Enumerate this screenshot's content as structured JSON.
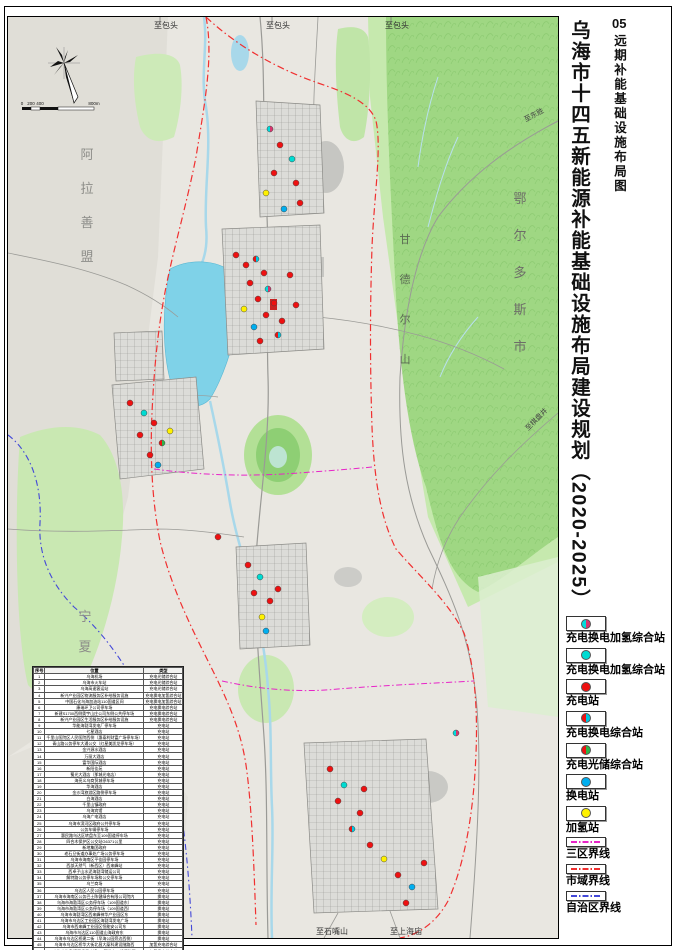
{
  "page": {
    "sheet_number": "05",
    "sheet_title": "远期补能基础设施布局图",
    "main_title": "乌海市十四五新能源补能基础设施布局建设规划（2020-2025）"
  },
  "legend": {
    "items": [
      {
        "label": "充电换电加氢综合站",
        "symbol": "point",
        "colors": [
          "#00DCDC",
          "#D8356E"
        ]
      },
      {
        "label": "充电换电加氢综合站",
        "symbol": "point",
        "colors": [
          "#00DCD2"
        ]
      },
      {
        "label": "充电站",
        "symbol": "point",
        "colors": [
          "#EE1111"
        ]
      },
      {
        "label": "充电换电综合站",
        "symbol": "point",
        "colors": [
          "#EE1111",
          "#00C8E0"
        ]
      },
      {
        "label": "充电光储综合站",
        "symbol": "point",
        "colors": [
          "#EE1111",
          "#2EB34A"
        ]
      },
      {
        "label": "换电站",
        "symbol": "point",
        "colors": [
          "#00AEEF"
        ]
      },
      {
        "label": "加氢站",
        "symbol": "point",
        "colors": [
          "#FFF100"
        ]
      },
      {
        "label": "三区界线",
        "symbol": "line",
        "colors": [
          "#E824C8"
        ]
      },
      {
        "label": "市域界线",
        "symbol": "line",
        "colors": [
          "#F03030"
        ]
      },
      {
        "label": "自治区界线",
        "symbol": "line",
        "colors": [
          "#4348D8"
        ]
      }
    ]
  },
  "table": {
    "headers": [
      "序号",
      "位置",
      "类型"
    ],
    "rows": [
      [
        1,
        "乌海机场",
        "充电光储综合站"
      ],
      [
        2,
        "乌海市火车站",
        "充电光储综合站"
      ],
      [
        3,
        "乌海高速客运站",
        "充电光储综合站"
      ],
      [
        4,
        "新兴产业园区物流服务区补给服务设施",
        "充电换电加氢综合站"
      ],
      [
        5,
        "中国石化乌海加油站110国道区间",
        "充电换电加氢综合站"
      ],
      [
        6,
        "康瑞环卫公司停车场",
        "充电换电综合站"
      ],
      [
        7,
        "新建S1700西侧奥宇山庄公司东侧公共停车场",
        "充电换电综合站"
      ],
      [
        8,
        "新兴产业园区生活服务区补给服务设施",
        "充电换电综合站"
      ],
      [
        9,
        "华能海勃湾发电厂停车场",
        "充电站"
      ],
      [
        10,
        "七星酒店",
        "充电站"
      ],
      [
        11,
        "千里山医院区人民医院西侧（惠泰利财富广场停车场）",
        "充电站"
      ],
      [
        12,
        "青山路公务停车大通公交（红星美凯龙停车场）",
        "充电站"
      ],
      [
        13,
        "金兴源水酒店",
        "充电站"
      ],
      [
        14,
        "万丽大酒店",
        "充电站"
      ],
      [
        15,
        "富华国际酒店",
        "充电站"
      ],
      [
        16,
        "新阳佳苑",
        "充电站"
      ],
      [
        17,
        "蜀光大酒店（那城光电店）",
        "充电站"
      ],
      [
        18,
        "海亮义乌商贸城停车场",
        "充电站"
      ],
      [
        19,
        "华海酒店",
        "充电站"
      ],
      [
        20,
        "金沙湾旅游区路侧停车场",
        "充电站"
      ],
      [
        21,
        "白海酒店",
        "充电站"
      ],
      [
        22,
        "千里山镇政府",
        "充电站"
      ],
      [
        23,
        "乌海宾馆",
        "充电站"
      ],
      [
        24,
        "乌海广电酒店",
        "充电站"
      ],
      [
        25,
        "乌海市滨河区政府公共停车场",
        "充电站"
      ],
      [
        26,
        "公务车辆停车场",
        "充电站"
      ],
      [
        27,
        "惠民路乌达区转盘东至109国道停车场",
        "充电站"
      ],
      [
        28,
        "四合木保护区公交站G6371公里",
        "充电站"
      ],
      [
        29,
        "新地集团政府",
        "充电站"
      ],
      [
        30,
        "老石旦街道办事处广场公务停车场",
        "充电站"
      ],
      [
        31,
        "乌海市海南区平佳园停车场",
        "充电站"
      ],
      [
        32,
        "西部天然气（新西区）西来峰站",
        "充电站"
      ],
      [
        33,
        "西卓子山水泥海勃湾储运公司",
        "充电站"
      ],
      [
        34,
        "解特路公务停车场和公交停车场",
        "充电站"
      ],
      [
        35,
        "乌兰商场",
        "充电站"
      ],
      [
        36,
        "乌达区人民公园停车场",
        "充电站"
      ],
      [
        37,
        "乌海市海南区公务巴士陈健绿合有限公司院内",
        "换电站"
      ],
      [
        38,
        "乌海市海勃湾区公务停车场（109国道东）",
        "换电站"
      ],
      [
        39,
        "乌海市海勃湾区公务停车场（109国道西）",
        "换电站"
      ],
      [
        40,
        "乌海市海勃湾区西来峰神华产业园区东",
        "换电站"
      ],
      [
        41,
        "乌海市乌达区工业园区海勃湾发电广场",
        "换电站"
      ],
      [
        42,
        "乌海市西来峰工业园区恒能安公司东",
        "换电站"
      ],
      [
        43,
        "乌海市乌达区110国道山海政府东",
        "换电站"
      ],
      [
        44,
        "乌海市乌达区桥建二街（早海公园旁边西侧）",
        "换电站"
      ],
      [
        45,
        "乌海市乌达区桥华大街北昌大厦科建设隧路西",
        "加氢充电综合站"
      ],
      [
        46,
        "乌海市海勃湾区千里山镇110国道东、低速路西",
        "加氢换电综合站"
      ]
    ]
  },
  "map": {
    "region_labels": [
      {
        "text": "阿拉善盟",
        "x": 79,
        "y": 142,
        "size": 13,
        "color": "#8d8d89",
        "vertical": true,
        "spacing": 34
      },
      {
        "text": "鄂尔多斯市",
        "x": 512,
        "y": 186,
        "size": 13,
        "color": "#6d6d68",
        "vertical": true,
        "spacing": 37
      },
      {
        "text": "宁夏回",
        "x": 77,
        "y": 604,
        "size": 13,
        "color": "#8d8d89",
        "vertical": true,
        "spacing": 30
      },
      {
        "text": "甘德尔山",
        "x": 397,
        "y": 226,
        "size": 11,
        "color": "#5a6a52",
        "vertical": true,
        "spacing": 40
      }
    ],
    "road_labels": [
      {
        "text": "至包头",
        "x": 158,
        "y": 11,
        "size": 8,
        "color": "#333333"
      },
      {
        "text": "至包头",
        "x": 270,
        "y": 11,
        "size": 8,
        "color": "#333333"
      },
      {
        "text": "至包头",
        "x": 389,
        "y": 11,
        "size": 8,
        "color": "#333333"
      },
      {
        "text": "至石嘴山",
        "x": 324,
        "y": 917,
        "size": 8,
        "color": "#333333"
      },
      {
        "text": "至上海庙",
        "x": 398,
        "y": 917,
        "size": 8,
        "color": "#333333"
      },
      {
        "text": "至东胜",
        "x": 527,
        "y": 100,
        "size": 7,
        "color": "#444444",
        "rotate": -28
      },
      {
        "text": "至棋盘井",
        "x": 530,
        "y": 404,
        "size": 7,
        "color": "#444444",
        "rotate": -45
      }
    ],
    "station_colors": {
      "cs": [
        "#EE1111"
      ],
      "bs": [
        "#00AEEF"
      ],
      "hs": [
        "#FFF100"
      ],
      "ccs": [
        "#EE1111",
        "#00C8E0"
      ],
      "cps": [
        "#EE1111",
        "#2EB34A"
      ],
      "chm": [
        "#00DCDC",
        "#D8356E"
      ],
      "chc": [
        "#00DCD2"
      ]
    },
    "stations": [
      {
        "x": 262,
        "y": 112,
        "t": "chm"
      },
      {
        "x": 272,
        "y": 128,
        "t": "cs"
      },
      {
        "x": 284,
        "y": 142,
        "t": "chc"
      },
      {
        "x": 266,
        "y": 156,
        "t": "cs"
      },
      {
        "x": 288,
        "y": 166,
        "t": "cs"
      },
      {
        "x": 258,
        "y": 176,
        "t": "hs"
      },
      {
        "x": 292,
        "y": 186,
        "t": "cs"
      },
      {
        "x": 276,
        "y": 192,
        "t": "bs"
      },
      {
        "x": 228,
        "y": 238,
        "t": "cs"
      },
      {
        "x": 238,
        "y": 248,
        "t": "cs"
      },
      {
        "x": 248,
        "y": 242,
        "t": "ccs"
      },
      {
        "x": 256,
        "y": 256,
        "t": "cs"
      },
      {
        "x": 242,
        "y": 266,
        "t": "cs"
      },
      {
        "x": 260,
        "y": 272,
        "t": "chm"
      },
      {
        "x": 250,
        "y": 282,
        "t": "cs"
      },
      {
        "x": 266,
        "y": 286,
        "t": "cs"
      },
      {
        "x": 236,
        "y": 292,
        "t": "hs"
      },
      {
        "x": 258,
        "y": 298,
        "t": "cs"
      },
      {
        "x": 274,
        "y": 304,
        "t": "cs"
      },
      {
        "x": 246,
        "y": 310,
        "t": "bs"
      },
      {
        "x": 282,
        "y": 258,
        "t": "cs"
      },
      {
        "x": 288,
        "y": 288,
        "t": "cs"
      },
      {
        "x": 252,
        "y": 324,
        "t": "cs"
      },
      {
        "x": 270,
        "y": 318,
        "t": "ccs"
      },
      {
        "x": 122,
        "y": 386,
        "t": "cs"
      },
      {
        "x": 136,
        "y": 396,
        "t": "chc"
      },
      {
        "x": 146,
        "y": 406,
        "t": "cs"
      },
      {
        "x": 132,
        "y": 418,
        "t": "cs"
      },
      {
        "x": 154,
        "y": 426,
        "t": "cps"
      },
      {
        "x": 142,
        "y": 438,
        "t": "cs"
      },
      {
        "x": 162,
        "y": 414,
        "t": "hs"
      },
      {
        "x": 150,
        "y": 448,
        "t": "bs"
      },
      {
        "x": 240,
        "y": 548,
        "t": "cs"
      },
      {
        "x": 252,
        "y": 560,
        "t": "chc"
      },
      {
        "x": 246,
        "y": 576,
        "t": "cs"
      },
      {
        "x": 262,
        "y": 584,
        "t": "cs"
      },
      {
        "x": 254,
        "y": 600,
        "t": "hs"
      },
      {
        "x": 270,
        "y": 572,
        "t": "cs"
      },
      {
        "x": 258,
        "y": 614,
        "t": "bs"
      },
      {
        "x": 322,
        "y": 752,
        "t": "cs"
      },
      {
        "x": 336,
        "y": 768,
        "t": "chc"
      },
      {
        "x": 330,
        "y": 784,
        "t": "cs"
      },
      {
        "x": 352,
        "y": 796,
        "t": "cs"
      },
      {
        "x": 344,
        "y": 812,
        "t": "ccs"
      },
      {
        "x": 362,
        "y": 828,
        "t": "cs"
      },
      {
        "x": 376,
        "y": 842,
        "t": "hs"
      },
      {
        "x": 390,
        "y": 858,
        "t": "cs"
      },
      {
        "x": 404,
        "y": 870,
        "t": "bs"
      },
      {
        "x": 416,
        "y": 846,
        "t": "cs"
      },
      {
        "x": 356,
        "y": 772,
        "t": "cs"
      },
      {
        "x": 398,
        "y": 886,
        "t": "cs"
      },
      {
        "x": 448,
        "y": 716,
        "t": "chm"
      },
      {
        "x": 210,
        "y": 520,
        "t": "cs"
      }
    ],
    "scalebar": {
      "labels": [
        "0",
        "200",
        "400",
        "800m"
      ]
    }
  }
}
